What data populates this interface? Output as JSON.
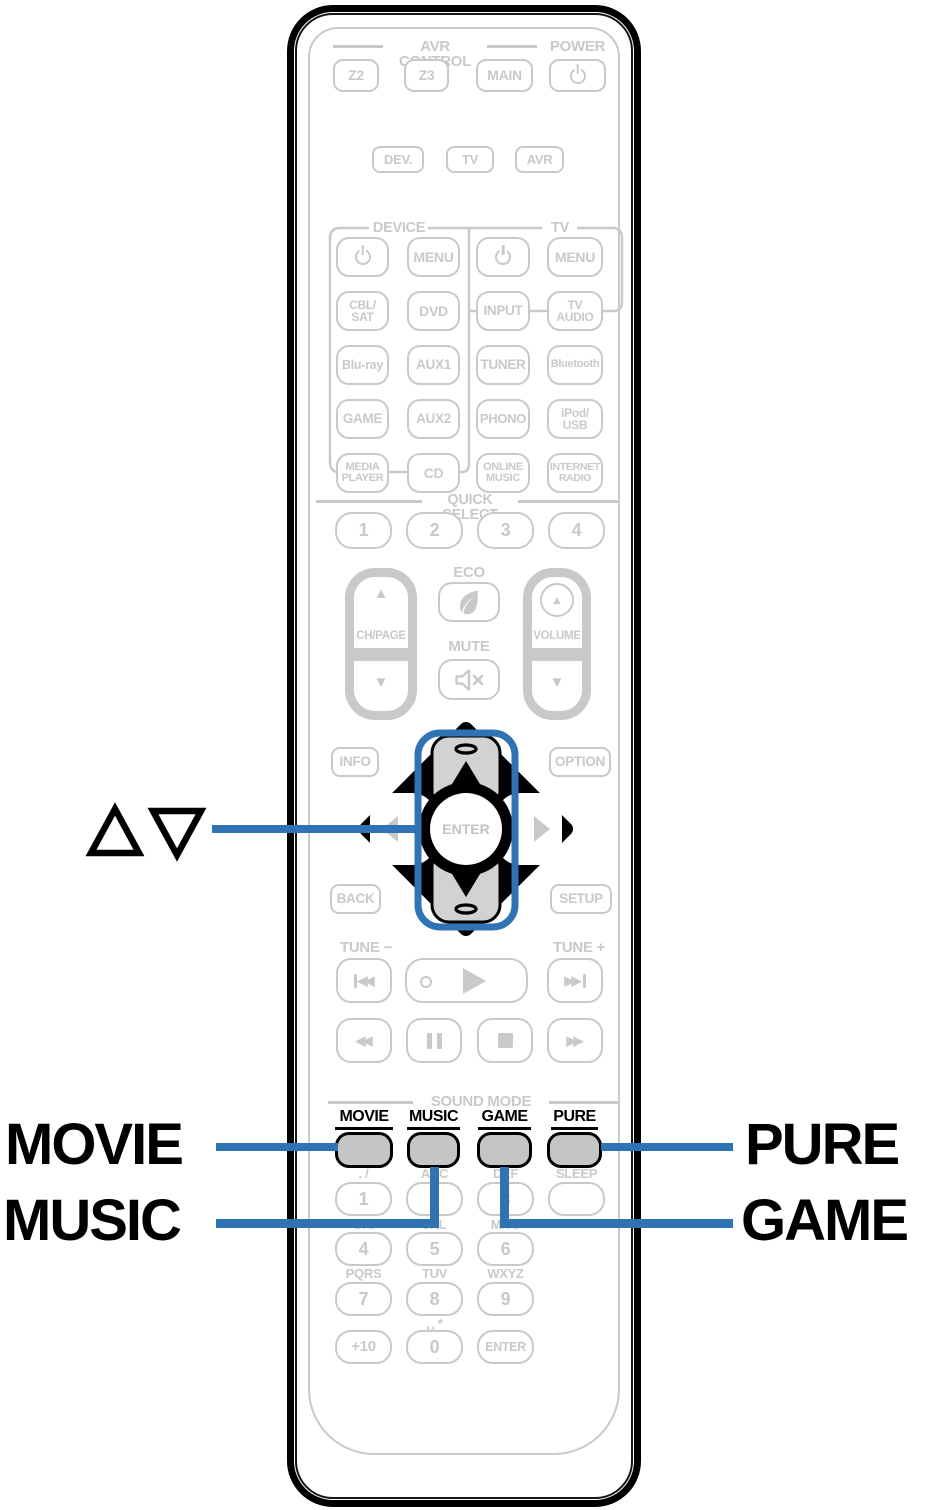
{
  "accent_color": "#2f73b5",
  "gray_color": "#c9c9c9",
  "callouts": {
    "cursor_updown": "△▽",
    "movie": "MOVIE",
    "music": "MUSIC",
    "pure": "PURE",
    "game": "GAME"
  },
  "top": {
    "avr_control_label": "AVR CONTROL",
    "power_label": "POWER",
    "z2": "Z2",
    "z3": "Z3",
    "main": "MAIN"
  },
  "remote_mode": {
    "dev": "DEV.",
    "tv": "TV",
    "avr": "AVR"
  },
  "device_section": {
    "label": "DEVICE",
    "menu": "MENU",
    "cbl_sat": "CBL/\nSAT",
    "dvd": "DVD",
    "blu_ray": "Blu-ray",
    "aux1": "AUX1",
    "game": "GAME",
    "aux2": "AUX2",
    "media_player": "MEDIA\nPLAYER",
    "cd": "CD"
  },
  "tv_section": {
    "label": "TV",
    "menu": "MENU",
    "input": "INPUT",
    "tv_audio": "TV\nAUDIO"
  },
  "sources": {
    "tuner": "TUNER",
    "bluetooth": "Bluetooth",
    "phono": "PHONO",
    "ipod_usb": "iPod/\nUSB",
    "online_music": "ONLINE\nMUSIC",
    "internet_radio": "INTERNET\nRADIO"
  },
  "quick_select": {
    "label": "QUICK SELECT",
    "b1": "1",
    "b2": "2",
    "b3": "3",
    "b4": "4"
  },
  "volume_section": {
    "eco_label": "ECO",
    "mute_label": "MUTE",
    "ch_page_label": "CH/PAGE",
    "volume_label": "VOLUME"
  },
  "nav": {
    "info": "INFO",
    "option": "OPTION",
    "back": "BACK",
    "setup": "SETUP",
    "enter": "ENTER"
  },
  "tune": {
    "minus": "TUNE −",
    "plus": "TUNE +"
  },
  "sound_mode": {
    "label": "SOUND MODE",
    "movie": "MOVIE",
    "music": "MUSIC",
    "game": "GAME",
    "pure": "PURE"
  },
  "keypad": {
    "letters_1": ". /",
    "digit_1": "1",
    "letters_2": "ABC",
    "digit_2": "2",
    "letters_3": "DEF",
    "digit_3": "3",
    "sleep_label": "SLEEP",
    "letters_4": "GHI",
    "digit_4": "4",
    "letters_5": "JKL",
    "digit_5": "5",
    "letters_6": "MNO",
    "digit_6": "6",
    "letters_7": "PQRS",
    "digit_7": "7",
    "letters_8": "TUV",
    "digit_8": "8",
    "letters_9": "WXYZ",
    "digit_9": "9",
    "plus10": "+10",
    "letters_0": "␣ *",
    "digit_0": "0",
    "enter": "ENTER"
  },
  "icons": {
    "up_triangle": "▲",
    "down_triangle": "▼",
    "double_left": "◀◀",
    "double_right": "▶▶"
  }
}
